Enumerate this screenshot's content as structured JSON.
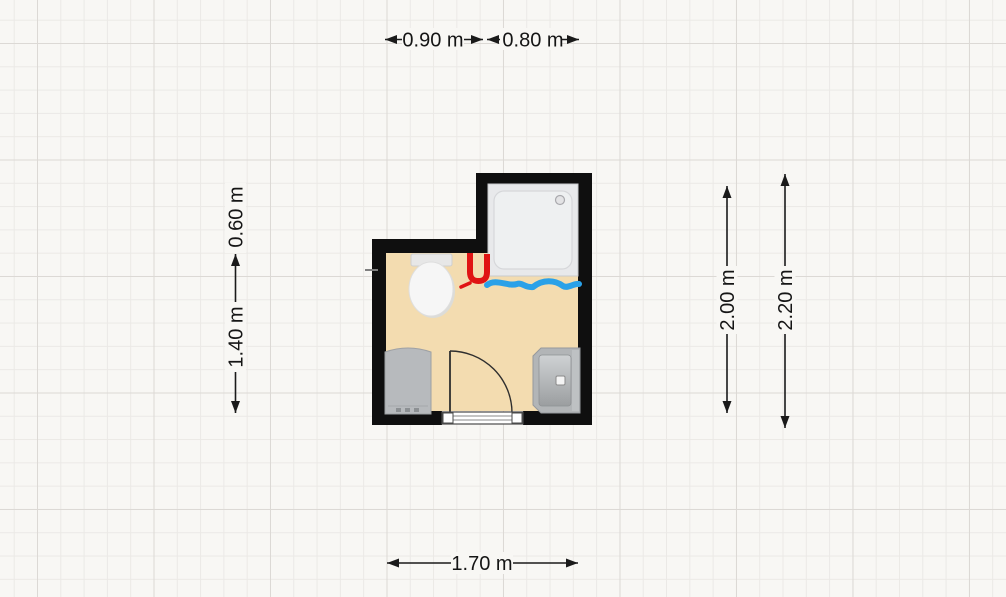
{
  "canvas": {
    "background": "#f8f7f4",
    "grid_minor_color": "#ebe9e6",
    "grid_major_color": "#dcd9d5"
  },
  "room": {
    "name": "bathroom",
    "floor_color": "#f3dcb0",
    "wall_color": "#0f0f0f"
  },
  "dimensions": {
    "top": [
      {
        "label": "0.90 m"
      },
      {
        "label": "0.80 m"
      }
    ],
    "left": [
      {
        "label": "0.60 m"
      },
      {
        "label": "1.40 m"
      }
    ],
    "right": [
      {
        "label": "2.00 m"
      },
      {
        "label": "2.20 m"
      }
    ],
    "bottom": [
      {
        "label": "1.70 m"
      }
    ]
  },
  "fixtures": [
    {
      "type": "shower-tray",
      "color": "#e8e9eb"
    },
    {
      "type": "toilet",
      "color": "#f6f6f6"
    },
    {
      "type": "washbasin",
      "color": "#b2b5b7"
    },
    {
      "type": "cabinet",
      "color": "#b7babd"
    },
    {
      "type": "door",
      "swing": "quarter-arc"
    }
  ],
  "annotations": [
    {
      "type": "marker",
      "shape": "u-shape",
      "color": "#e01414"
    },
    {
      "type": "marker",
      "shape": "wavy-line",
      "color": "#2aa1e8"
    }
  ]
}
